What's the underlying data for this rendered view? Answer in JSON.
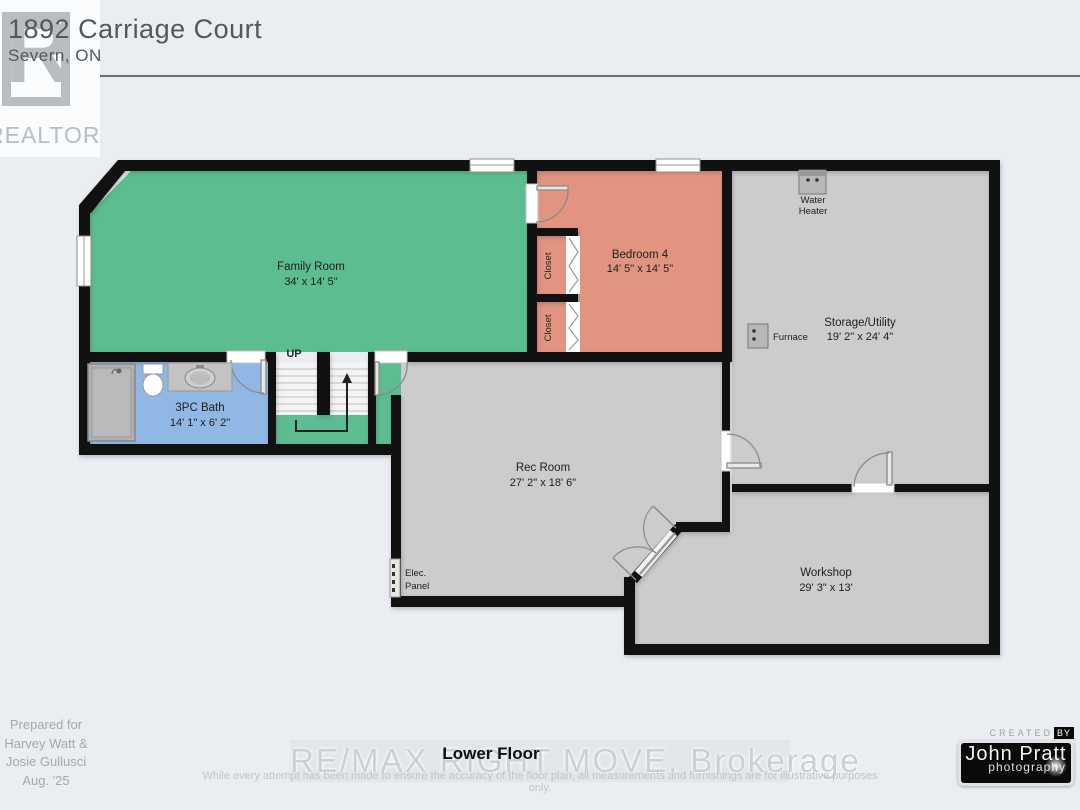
{
  "header": {
    "address": "1892 Carriage Court",
    "city": "Severn, ON",
    "realtor": {
      "letter": "R",
      "wordmark": "REALTOR®"
    }
  },
  "plan": {
    "floor_label": "Lower Floor",
    "rooms": {
      "family": {
        "name": "Family Room",
        "dims": "34' x 14' 5\""
      },
      "bedroom4": {
        "name": "Bedroom 4",
        "dims": "14' 5\" x 14' 5\""
      },
      "storage": {
        "name": "Storage/Utility",
        "dims": "19' 2\" x 24' 4\""
      },
      "bath": {
        "name": "3PC Bath",
        "dims": "14' 1\" x 6' 2\""
      },
      "rec": {
        "name": "Rec Room",
        "dims": "27' 2\" x 18' 6\""
      },
      "workshop": {
        "name": "Workshop",
        "dims": "29' 3\" x 13'"
      }
    },
    "features": {
      "closet_top": "Closet",
      "closet_bottom": "Closet",
      "water_heater_1": "Water",
      "water_heater_2": "Heater",
      "furnace": "Furnace",
      "elec_1": "Elec.",
      "elec_2": "Panel",
      "stairs_up": "UP"
    },
    "colors": {
      "family": "#5cbd90",
      "bedroom": "#e29481",
      "bath": "#8fb9e4",
      "utility": "#cccccc",
      "wall": "#111111"
    }
  },
  "footer": {
    "prepared_lines": [
      "Prepared for",
      "Harvey Watt &",
      "Josie Gullusci",
      "Aug. '25"
    ],
    "watermark": "RE/MAX RIGHT MOVE, Brokerage",
    "disclaimer": "While every attempt has been made to ensure the accuracy of the floor plan, all measurements and furnishings are for illustrative purposes only.",
    "credit": {
      "created": "CREATED",
      "by": "BY",
      "name": "John Pratt",
      "sub": "photography"
    }
  }
}
